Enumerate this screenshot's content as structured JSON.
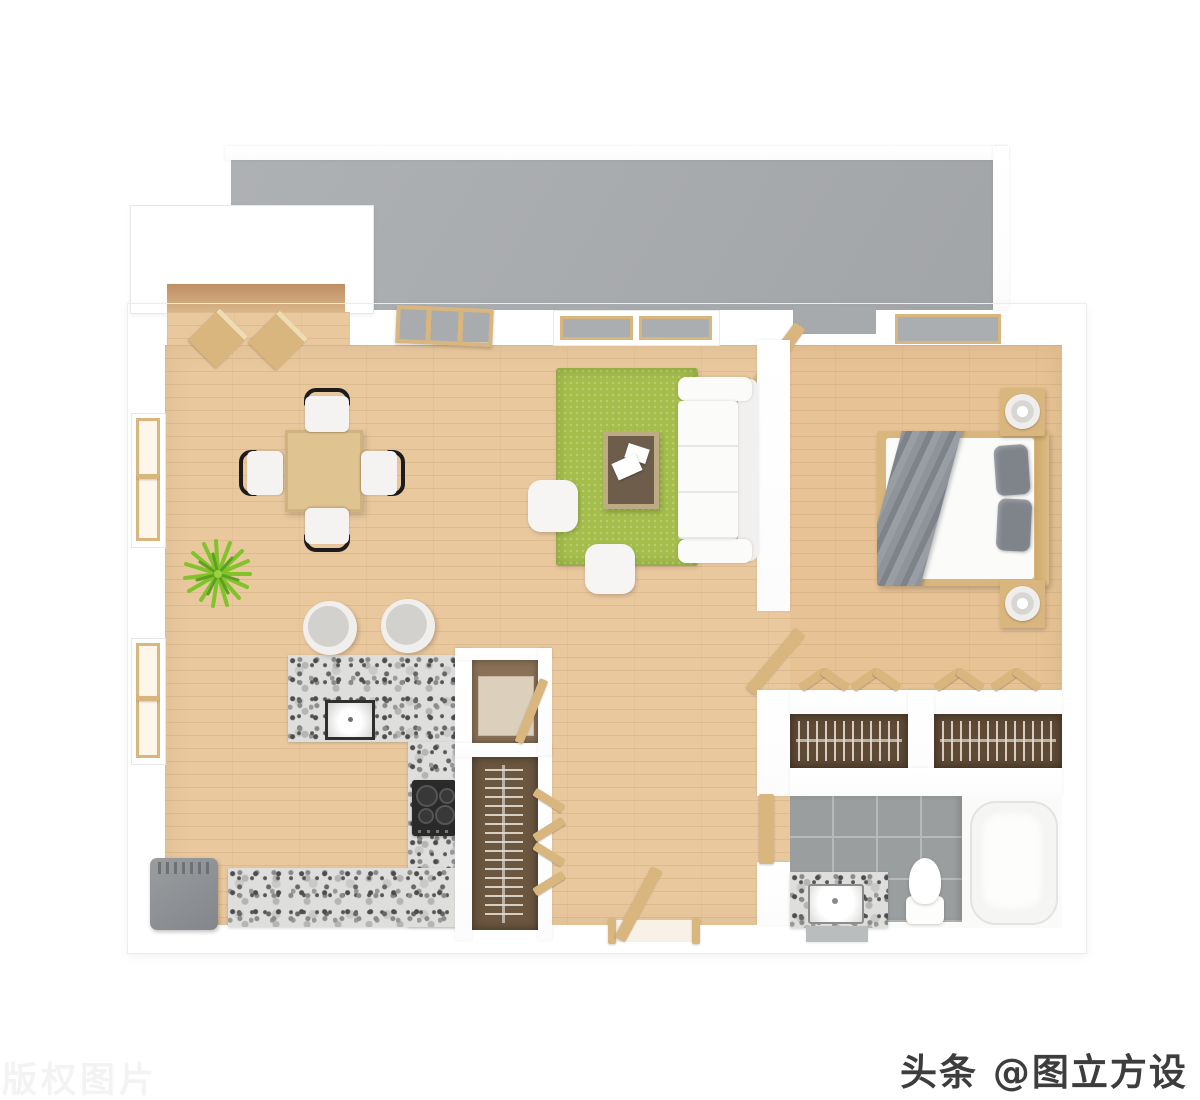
{
  "watermarks": {
    "brand_label": "头条 @图立方设计",
    "copyright_label": "版权图片"
  },
  "colors": {
    "wood": "#e9c89e",
    "wood_accent": "#d8b67d",
    "balcony": "#a7aaad",
    "rug": "#a4bd4b",
    "closet": "#5e4a35",
    "granite": "#dededc",
    "tile": "#9b9e9f",
    "tile_line": "#b7baba",
    "blanket": "#878c92",
    "pillow": "#7f848b",
    "gray_box": "#8f9295",
    "plant_a": "#82c32c",
    "plant_b": "#5ea021",
    "wm_dark": "#3d3d3d",
    "wm_light": "#f3f3f3"
  },
  "rooms": [
    "balcony",
    "entry",
    "dining-area",
    "kitchen",
    "living-room",
    "hallway",
    "bedroom",
    "closets",
    "bathroom"
  ],
  "furniture": [
    "dining-table",
    "dining-chairs",
    "potted-plant",
    "bar-stools",
    "kitchen-counter",
    "kitchen-sink",
    "cooktop",
    "refrigerator",
    "pantry-cabinet",
    "pantry-closet",
    "area-rug",
    "coffee-table",
    "magazines",
    "sofa",
    "ottomans",
    "double-bed",
    "blanket",
    "pillows",
    "nightstands",
    "table-lamps",
    "wardrobe-closets",
    "hanger-rods",
    "bathtub",
    "vanity-sink",
    "toilet",
    "bath-mat",
    "windows",
    "doors"
  ]
}
